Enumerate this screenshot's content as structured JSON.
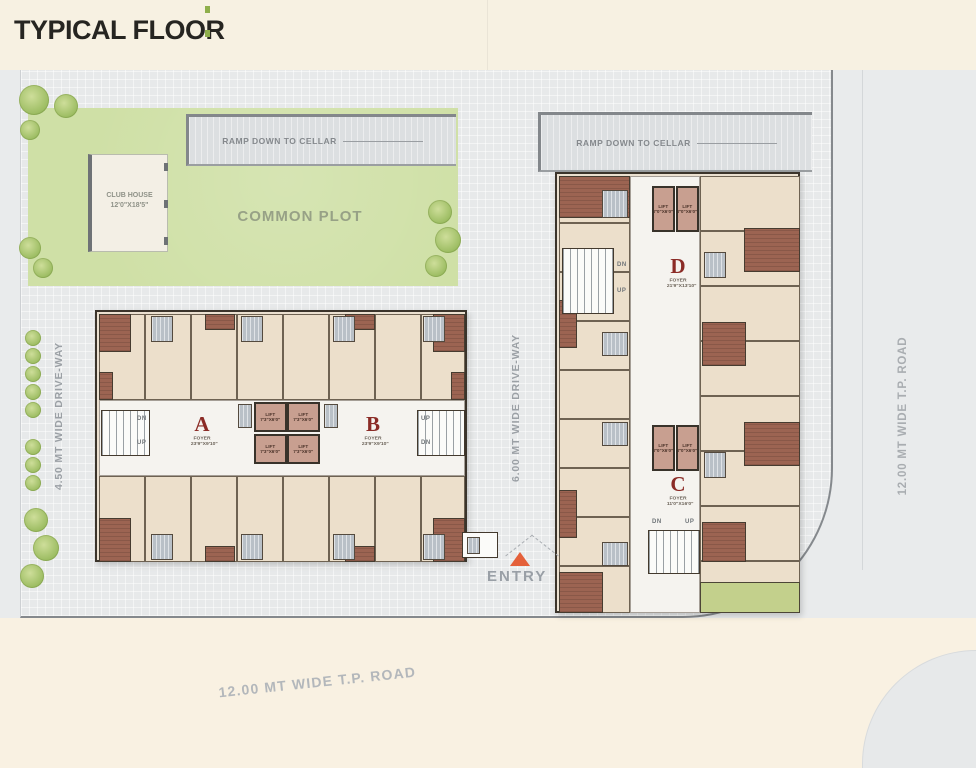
{
  "title": "TYPICAL FLOOR",
  "site": {
    "common_plot": "COMMON PLOT",
    "club_house": {
      "line1": "CLUB HOUSE",
      "line2": "12'0\"X18'5\""
    },
    "ramp_left": "RAMP DOWN TO CELLAR",
    "ramp_right": "RAMP DOWN TO CELLAR",
    "entry": "ENTRY"
  },
  "roads": {
    "left_driveway": "4.50 MT WIDE DRIVE-WAY",
    "center_driveway": "6.00 MT WIDE DRIVE-WAY",
    "right_tp_road": "12.00 MT WIDE T.P. ROAD",
    "bottom_tp_road": "12.00 MT WIDE T.P. ROAD"
  },
  "wings": {
    "A": {
      "letter": "A",
      "foyer": "FOYER",
      "size": "23'9\"X9'10\""
    },
    "B": {
      "letter": "B",
      "foyer": "FOYER",
      "size": "23'9\"X9'10\""
    },
    "C": {
      "letter": "C",
      "foyer": "FOYER",
      "size": "11'0\"X16'0\""
    },
    "D": {
      "letter": "D",
      "foyer": "FOYER",
      "size": "21'9\"X13'10\""
    }
  },
  "lift": {
    "label": "LIFT",
    "size_ab": "7'3\"X6'0\"",
    "size_cd": "7'0\"X6'0\""
  },
  "stairs": {
    "up": "UP",
    "dn": "DN"
  },
  "colors": {
    "header_bg": "#f7f1e2",
    "site_gray": "#e7e9ea",
    "common_plot_green": "#cfe0a6",
    "balcony_terracotta": "#9c6452",
    "lift_pink": "#c89f90",
    "wing_letter_red": "#8b2b26",
    "entry_arrow_orange": "#e4603a",
    "accent_green": "#8faf4b",
    "road_cream": "#f9f1e2"
  }
}
